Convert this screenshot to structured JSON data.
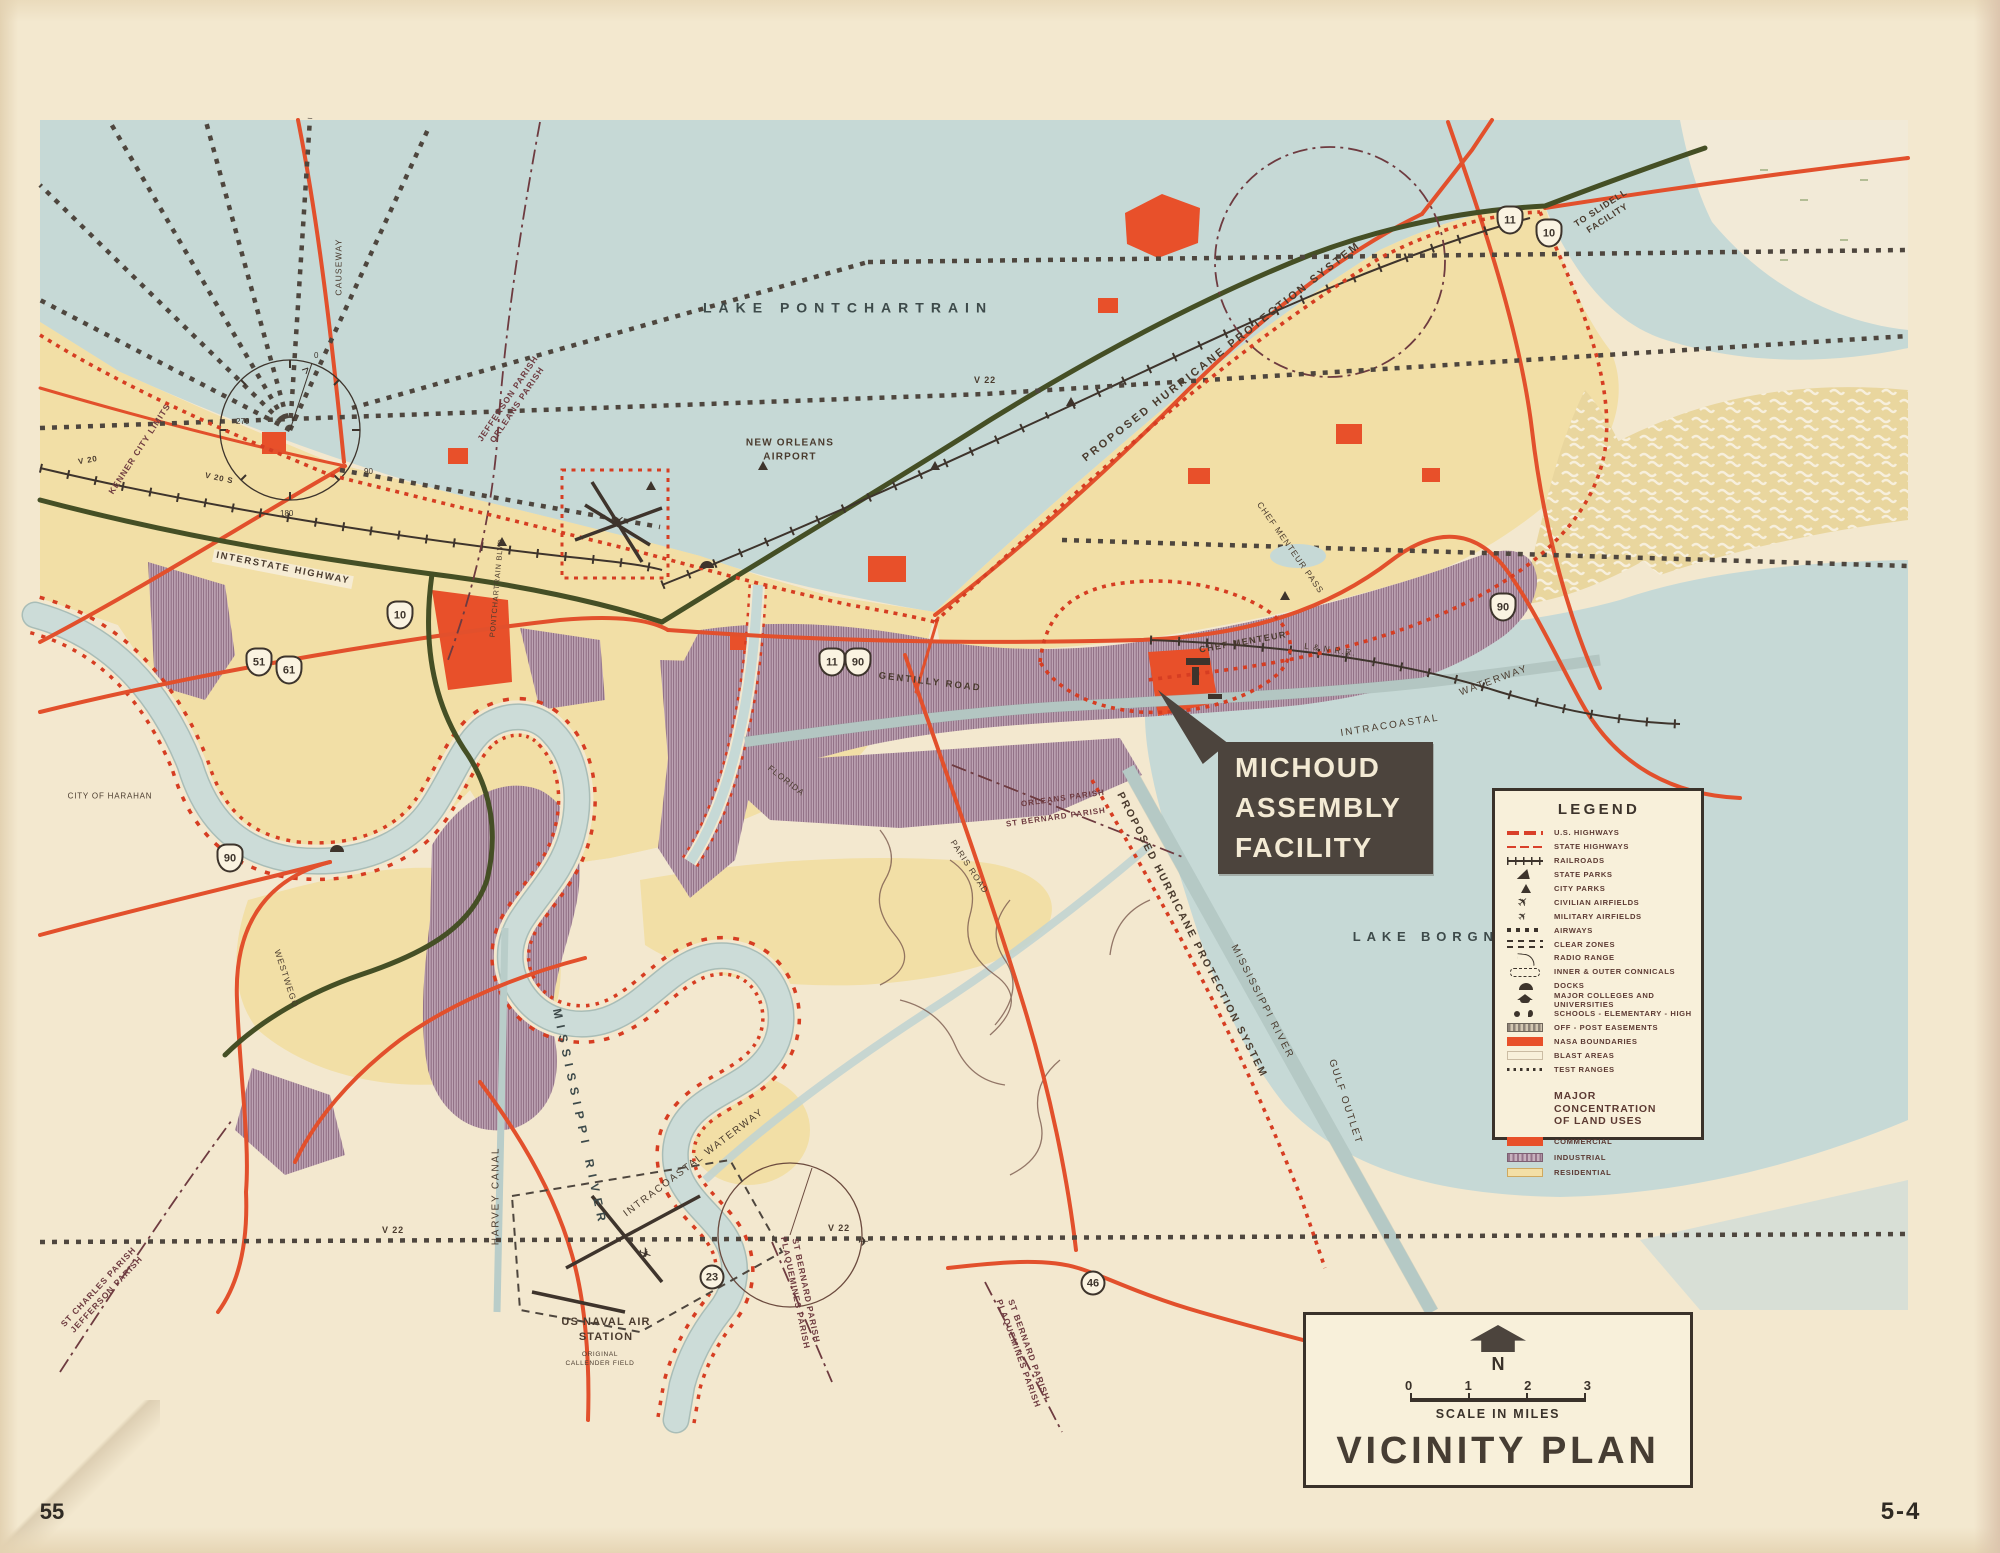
{
  "page": {
    "sheet_number": "5-4",
    "corner_number": "55"
  },
  "callout": {
    "line1": "MICHOUD",
    "line2": "ASSEMBLY",
    "line3": "FACILITY"
  },
  "title_block": {
    "north_label": "N",
    "scale_ticks": [
      "0",
      "1",
      "2",
      "3"
    ],
    "scale_caption": "SCALE IN MILES",
    "title": "VICINITY PLAN"
  },
  "legend": {
    "title": "LEGEND",
    "items": [
      {
        "symbol": "us-highways-line",
        "label": "U.S. HIGHWAYS"
      },
      {
        "symbol": "state-highways-line",
        "label": "STATE HIGHWAYS"
      },
      {
        "symbol": "railroad-line",
        "label": "RAILROADS"
      },
      {
        "symbol": "state-park-icon",
        "label": "STATE PARKS"
      },
      {
        "symbol": "city-park-icon",
        "label": "CITY PARKS"
      },
      {
        "symbol": "civilian-airfield-icon",
        "label": "CIVILIAN AIRFIELDS"
      },
      {
        "symbol": "military-airfield-icon",
        "label": "MILITARY AIRFIELDS"
      },
      {
        "symbol": "airways-dots",
        "label": "AIRWAYS"
      },
      {
        "symbol": "clear-zones-dashes",
        "label": "CLEAR ZONES"
      },
      {
        "symbol": "radio-range-arc",
        "label": "RADIO RANGE"
      },
      {
        "symbol": "conical-dashed-box",
        "label": "INNER & OUTER CONNICALS"
      },
      {
        "symbol": "dock-icon",
        "label": "DOCKS"
      },
      {
        "symbol": "college-icon",
        "label": "MAJOR COLLEGES AND UNIVERSITIES"
      },
      {
        "symbol": "school-dots",
        "label": "SCHOOLS - ELEMENTARY - HIGH"
      },
      {
        "symbol": "offpost-swatch",
        "label": "OFF - POST EASEMENTS"
      },
      {
        "symbol": "nasa-swatch",
        "label": "NASA BOUNDARIES"
      },
      {
        "symbol": "blast-swatch",
        "label": "BLAST AREAS"
      },
      {
        "symbol": "test-range-dots",
        "label": "TEST RANGES"
      }
    ],
    "land_use_title": "MAJOR CONCENTRATION\nOF LAND USES",
    "land_use": [
      {
        "symbol": "commercial-swatch",
        "label": "COMMERCIAL",
        "color": "#e8502a"
      },
      {
        "symbol": "industrial-swatch",
        "label": "INDUSTRIAL",
        "color": "#b79fb0"
      },
      {
        "symbol": "residential-swatch",
        "label": "RESIDENTIAL",
        "color": "#f3dfa6"
      }
    ]
  },
  "plane_glyph": "✈",
  "compass": {
    "n0": "0",
    "n90": "90",
    "n180": "180",
    "n270": "270"
  },
  "colors": {
    "paper": "#f3e8cf",
    "water": "#c6d9d6",
    "residential": "#f2dfa6",
    "industrial": "#b79fb0",
    "commercial": "#e8502a",
    "road_red": "#e2502c",
    "interstate_green": "#454f25",
    "callout_bg": "#4c443d",
    "hurricane_red": "#d63d22"
  },
  "labels": [
    {
      "t": "LAKE  PONTCHARTRAIN"
    },
    {
      "t": "LAKE  BORGNE"
    },
    {
      "t": "NEW ORLEANS\nAIRPORT"
    },
    {
      "t": "TO SLIDELL\nFACILITY"
    },
    {
      "t": "PROPOSED   HURRICANE   PROTECTION   SYSTEM"
    },
    {
      "t": "PROPOSED  HURRICANE  PROTECTION  SYSTEM"
    },
    {
      "t": "MISSISSIPPI  RIVER"
    },
    {
      "t": "GULF  OUTLET"
    },
    {
      "t": "INTRACOASTAL"
    },
    {
      "t": "WATERWAY"
    },
    {
      "t": "INTRACOASTAL  WATERWAY"
    },
    {
      "t": "HARVEY  CANAL"
    },
    {
      "t": "US NAVAL AIR\nSTATION"
    },
    {
      "t": "ORIGINAL\nCALLENDER FIELD"
    },
    {
      "t": "MISSISSIPPI  RIVER"
    },
    {
      "t": "GENTILLY  ROAD"
    },
    {
      "t": "CHEF  MENTEUR"
    },
    {
      "t": "L & N  R.R."
    },
    {
      "t": "CHEF MENTEUR PASS"
    },
    {
      "t": "JEFFERSON  PARISH\nORLEANS  PARISH"
    },
    {
      "t": "ST CHARLES  PARISH\nJEFFERSON  PARISH"
    },
    {
      "t": "ORLEANS PARISH"
    },
    {
      "t": "ST BERNARD PARISH"
    },
    {
      "t": "ST BERNARD PARISH\nPLAQUEMINES PARISH"
    },
    {
      "t": "ST BERNARD PARISH\nPLAQUEMINES PARISH"
    },
    {
      "t": "KENNER CITY LIMITS"
    },
    {
      "t": "CITY OF HARAHAN"
    },
    {
      "t": "WESTWEGO"
    },
    {
      "t": "INTERSTATE  HIGHWAY"
    },
    {
      "t": "CAUSEWAY"
    },
    {
      "t": "PONTCHARTRAIN  BLVD"
    },
    {
      "t": "FLORIDA"
    },
    {
      "t": "PARIS  ROAD"
    },
    {
      "t": "V 22"
    },
    {
      "t": "V 20"
    },
    {
      "t": "V 20 S"
    },
    {
      "t": "V 22"
    },
    {
      "t": "V 22"
    }
  ],
  "shields": [
    {
      "num": "10"
    },
    {
      "num": "11"
    },
    {
      "num": "11"
    },
    {
      "num": "90"
    },
    {
      "num": "51"
    },
    {
      "num": "61"
    },
    {
      "num": "90"
    },
    {
      "num": "90"
    },
    {
      "num": "10"
    },
    {
      "num": "23"
    },
    {
      "num": "46"
    }
  ]
}
